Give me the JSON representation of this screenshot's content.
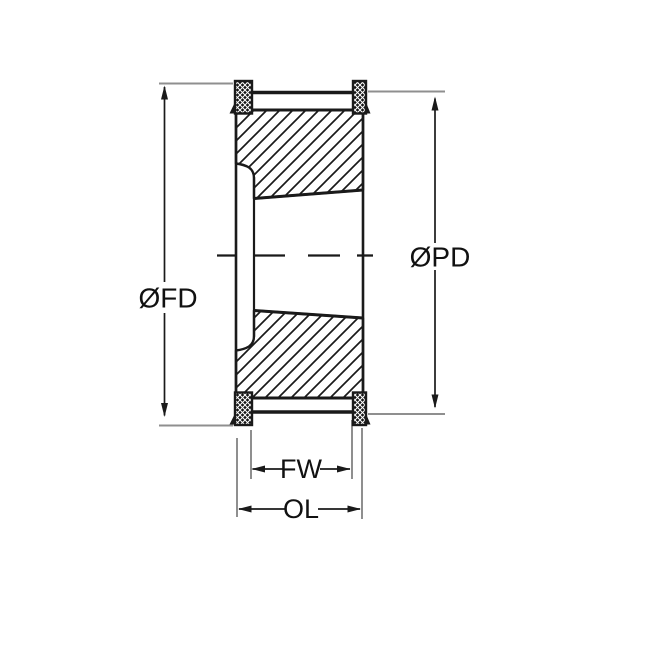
{
  "diagram": {
    "background": "#ffffff",
    "line_color": "#1a1a1a",
    "extension_line_color": "#8f8f8f",
    "labels": {
      "flange_diameter": "ØFD",
      "pitch_diameter": "ØPD",
      "face_width": "FW",
      "overall_length": "OL"
    }
  }
}
